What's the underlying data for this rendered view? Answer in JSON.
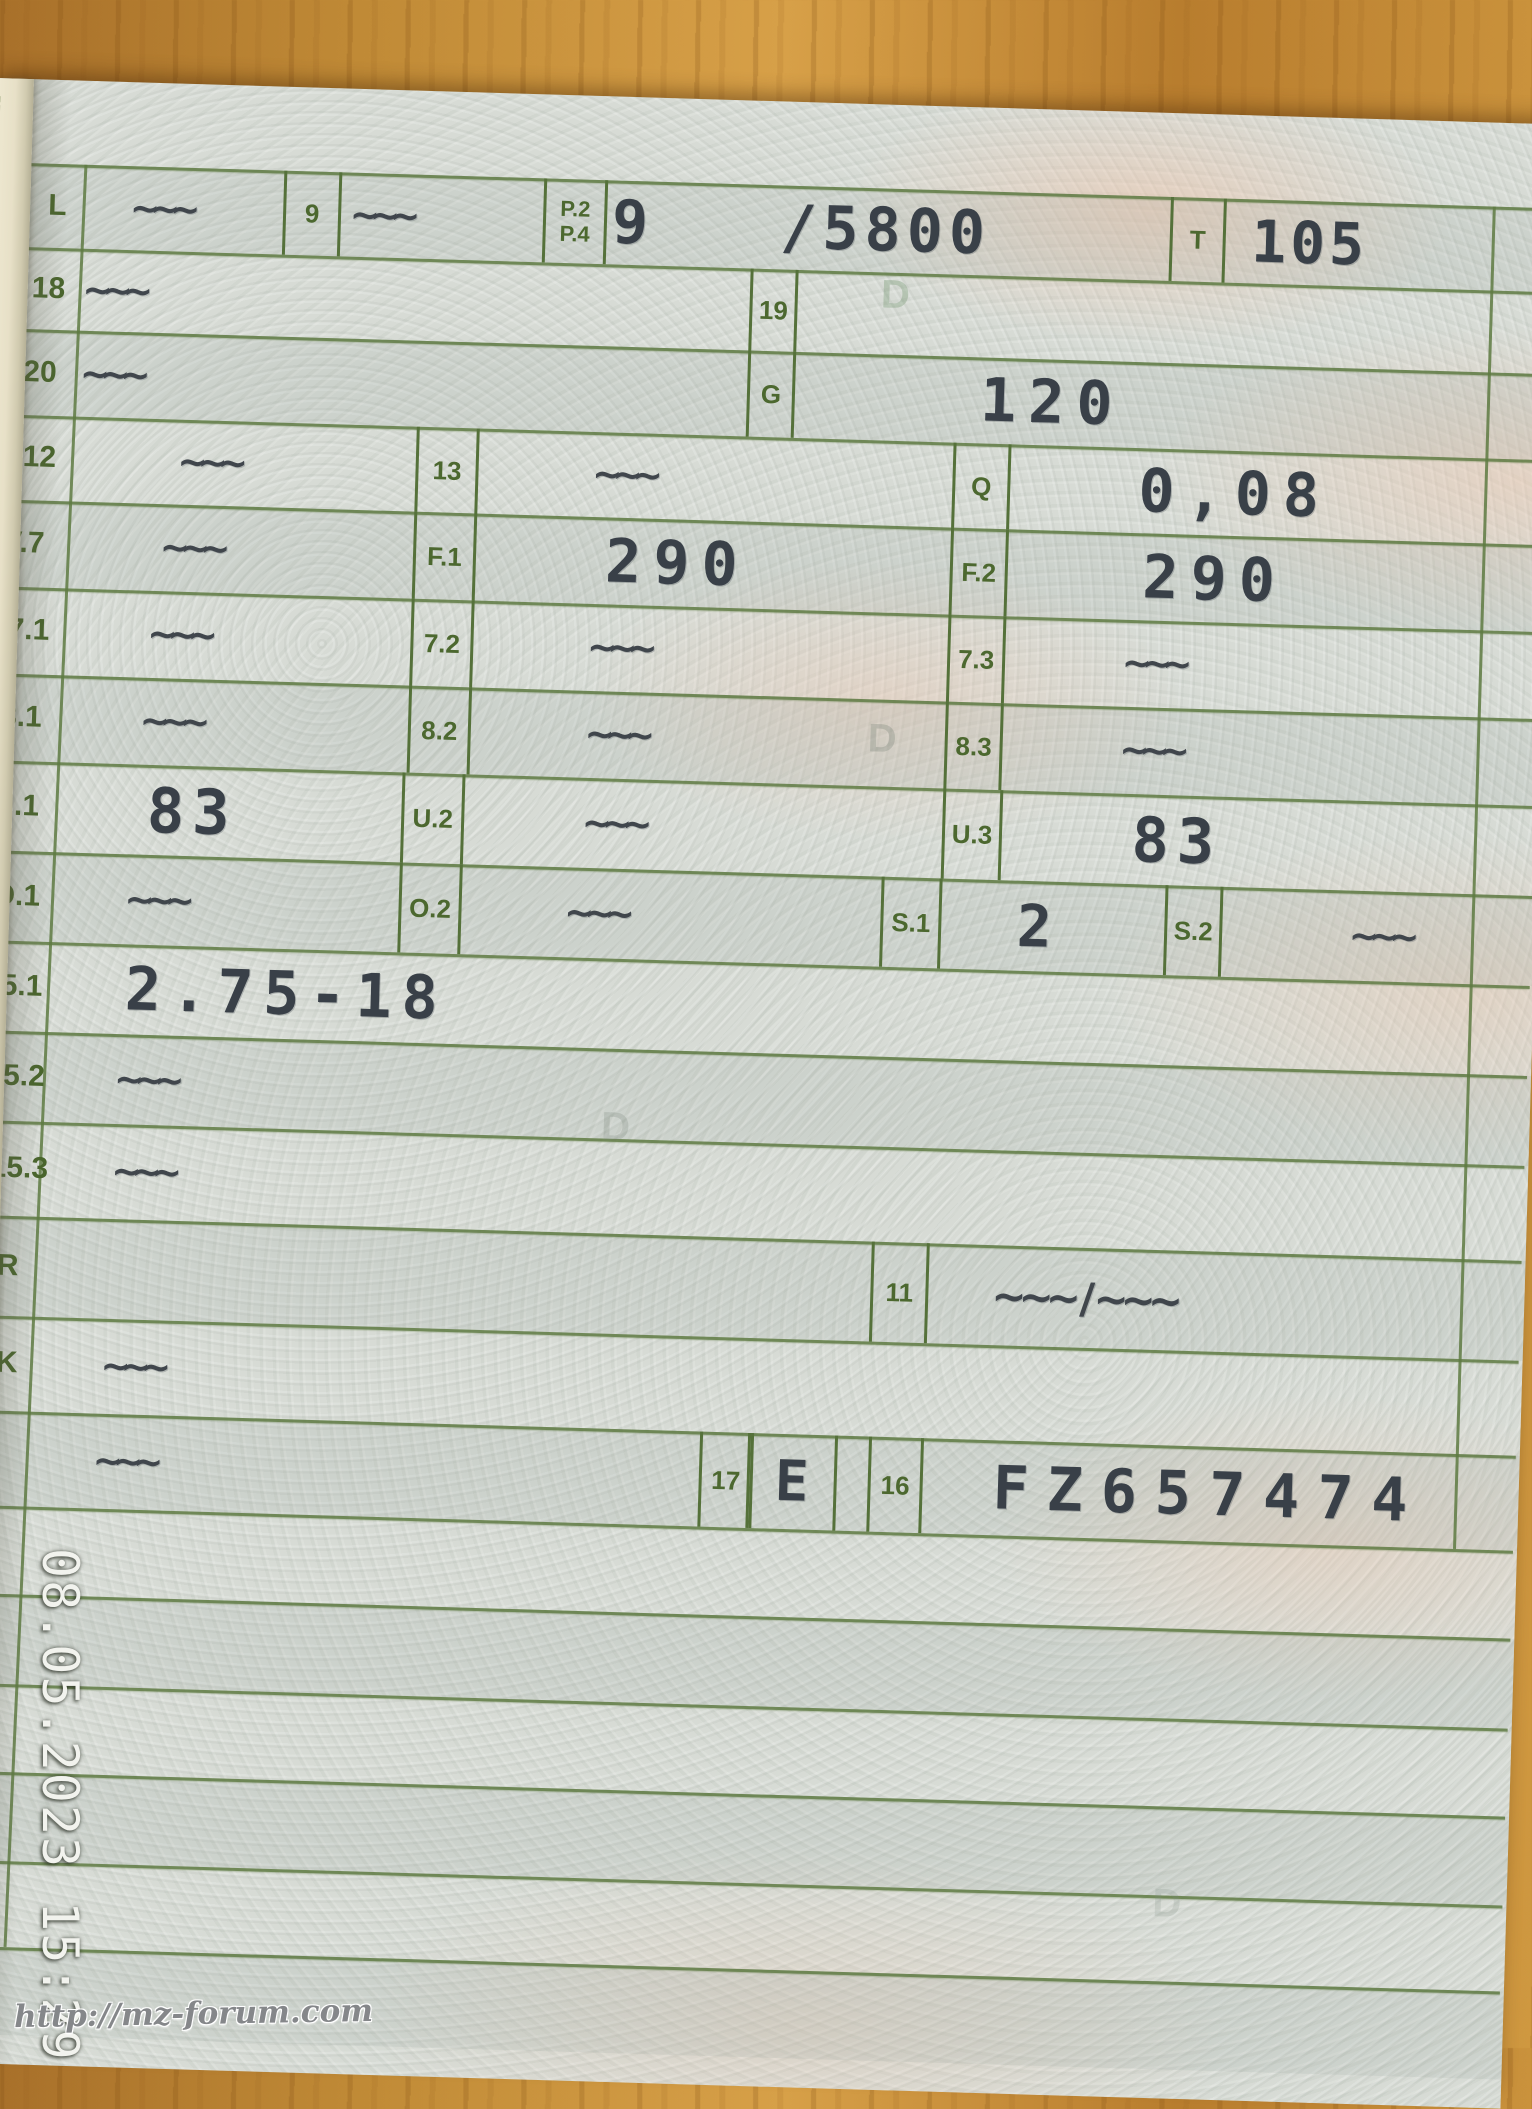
{
  "overlay": {
    "timestamp": "08.05.2023 15:29",
    "watermark": "http://mz-forum.com"
  },
  "colors": {
    "grid_green": "#5e7a42",
    "value_ink": "#394048",
    "paper": "#d7dbd5",
    "wood": "#c08a36",
    "fold_beige": "#e7e0c7"
  },
  "rows": {
    "L": {
      "label": "L",
      "dash1": "~~~",
      "box9": "9",
      "dash2": "~~~",
      "p2": "P.2",
      "p4": "P.4",
      "power_value": "9   /5800",
      "t_label": "T",
      "t_value": "105"
    },
    "r18": {
      "label": "18",
      "value": "~~~",
      "box19": "19"
    },
    "r20": {
      "label": "20",
      "value": "~~~",
      "boxG": "G",
      "g_value": "120"
    },
    "r12": {
      "label": "12",
      "value": "~~~",
      "box13": "13",
      "v13": "~~~",
      "boxQ": "Q",
      "vQ": "0,08"
    },
    "v7": {
      "label": "V.7",
      "value": "~~~",
      "boxF1": "F.1",
      "vF1": "290",
      "boxF2": "F.2",
      "vF2": "290"
    },
    "r71": {
      "label": "7.1",
      "value": "~~~",
      "box72": "7.2",
      "v72": "~~~",
      "box73": "7.3",
      "v73": "~~~"
    },
    "r81": {
      "label": "8.1",
      "value": "~~~",
      "box82": "8.2",
      "v82": "~~~",
      "box83": "8.3",
      "v83": "~~~"
    },
    "u1": {
      "label": "U.1",
      "value": "83",
      "boxU2": "U.2",
      "vU2": "~~~",
      "boxU3": "U.3",
      "vU3": "83"
    },
    "o1": {
      "label": "O.1",
      "value": "~~~",
      "boxO2": "O.2",
      "vO2": "~~~",
      "boxS1": "S.1",
      "vS1": "2",
      "boxS2": "S.2",
      "vS2": "~~~"
    },
    "r151": {
      "label": "15.1",
      "value": "2.75-18"
    },
    "r152": {
      "label": "15.2",
      "value": "~~~"
    },
    "r153": {
      "label": "15.3",
      "value": "~~~"
    },
    "rR": {
      "label": "R",
      "box11": "11",
      "v11": "~~~ / ~~~"
    },
    "rK": {
      "label": "K",
      "value": "~~~"
    },
    "r16": {
      "value": "~~~",
      "box17": "17",
      "v17": "E",
      "box16": "16",
      "v16": "FZ657474"
    }
  },
  "ghost_marks": {
    "d1": "D",
    "d2": "D",
    "d3": "D",
    "d4": "D"
  }
}
